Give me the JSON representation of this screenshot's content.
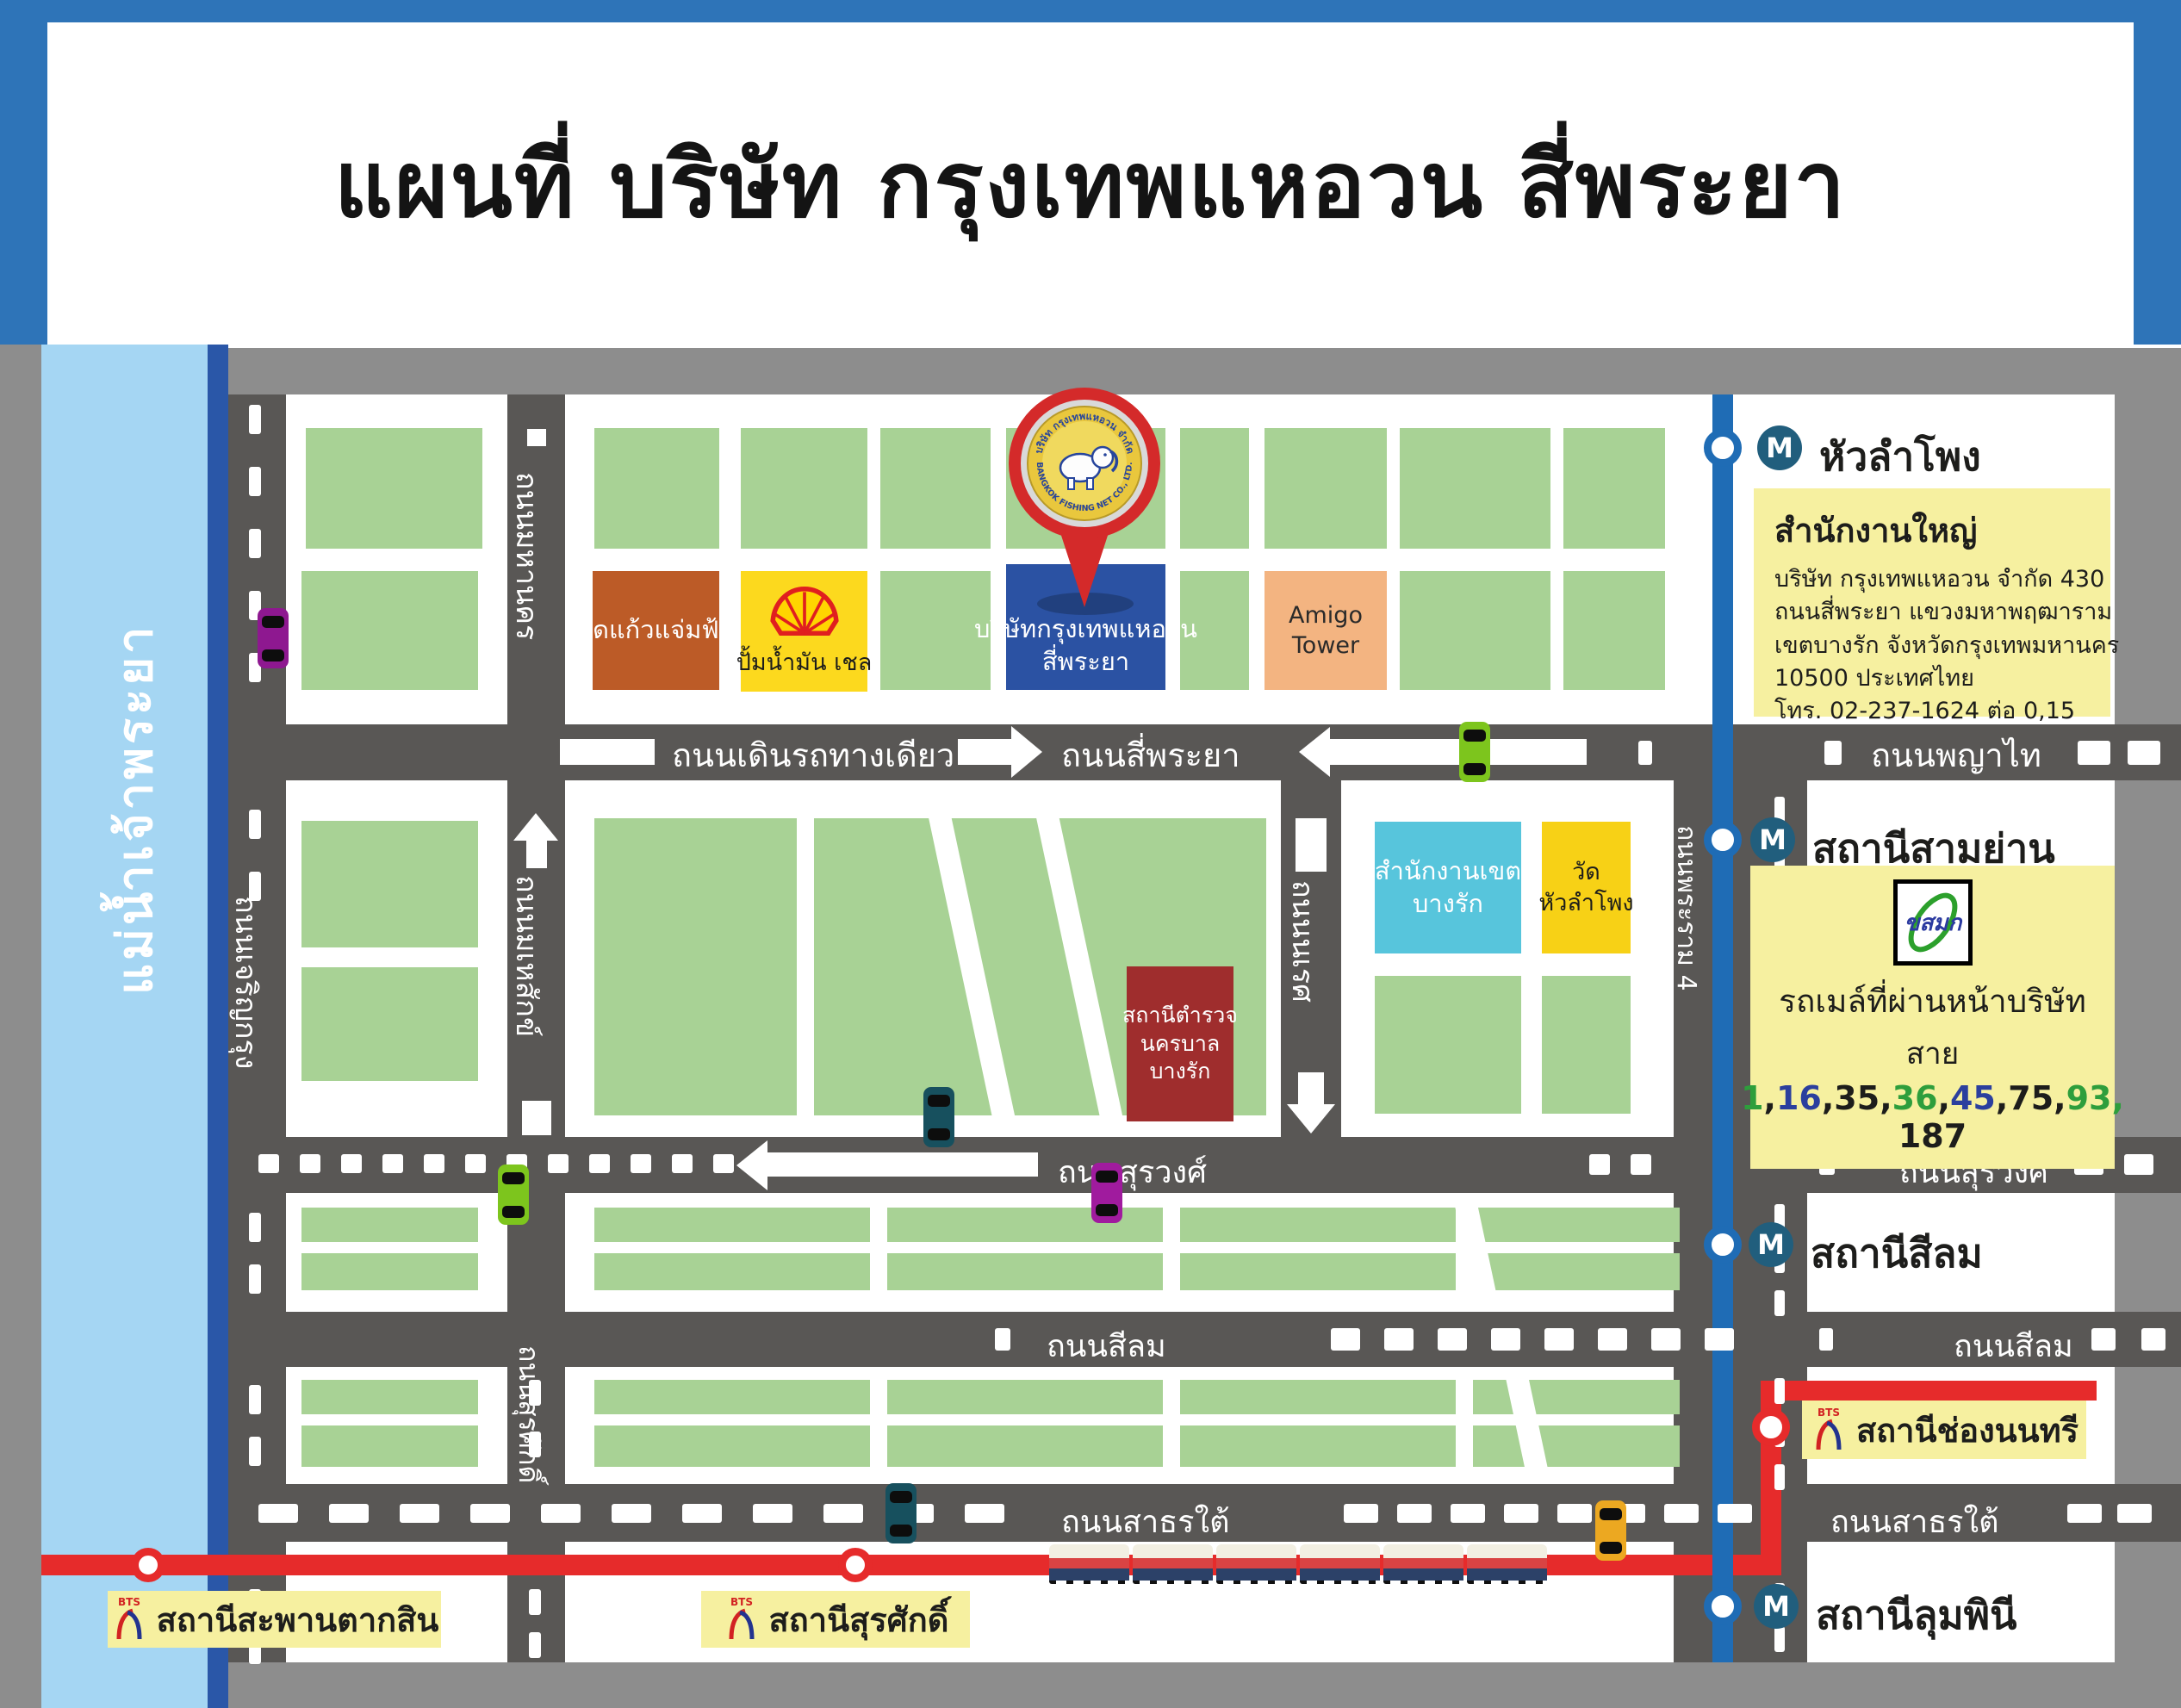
{
  "title": "แผนที่ บริษัท กรุงเทพแหอวน สี่พระยา",
  "river": {
    "name": "แม่น้ำเจ้าพระยา"
  },
  "roads": {
    "one_way": "ถนนเดินรถทางเดียว",
    "si_phraya": "ถนนสี่พระยา",
    "phaya_thai": "ถนนพญาไท",
    "surawong": "ถนนสุรวงศ์",
    "silom": "ถนนสีลม",
    "sathorn_tai": "ถนนสาธรใต้",
    "charoen_krung": "ถนนเจริญกรุง",
    "maha_nakhon": "ถนนมหานคร",
    "mahesak": "ถนนมเหสักข์",
    "naret": "ถนนนเรศ",
    "surasak": "ถนนสุรศักดิ์",
    "rama4": "ถนนพระราม 4"
  },
  "buildings": {
    "wat_kaew": "วัดแก้วแจ่มฟ้า",
    "shell": "ปั้มน้ำมัน เชล",
    "company_line1": "บริษัทกรุงเทพแหอวน",
    "company_line2": "สี่พระยา",
    "amigo_line1": "Amigo",
    "amigo_line2": "Tower",
    "district_line1": "สำนักงานเขต",
    "district_line2": "บางรัก",
    "wat_hl_line1": "วัด",
    "wat_hl_line2": "หัวลำโพง",
    "police_line1": "สถานีตำรวจ",
    "police_line2": "นครบาล",
    "police_line3": "บางรัก"
  },
  "pin": {
    "arc_top": "บริษัท กรุงเทพแหอวน จำกัด",
    "arc_bottom": "BANGKOK FISHING NET CO., LTD."
  },
  "mrt": {
    "icon": "M",
    "stations": {
      "hua_lamphong": "หัวลำโพง",
      "sam_yan": "สถานีสามย่าน",
      "silom": "สถานีสีลม",
      "lumpini": "สถานีลุมพินี"
    }
  },
  "bts": {
    "logo": "BTS",
    "stations": {
      "chong_nonsi": "สถานีช่องนนทรี",
      "taksin": "สถานีสะพานตากสิน",
      "surasak": "สถานีสุรศักดิ์"
    }
  },
  "office_box": {
    "title": "สำนักงานใหญ่",
    "line1": "บริษัท กรุงเทพแหอวน จำกัด 430",
    "line2": "ถนนสี่พระยา แขวงมหาพฤฒาราม",
    "line3": "เขตบางรัก จังหวัดกรุงเทพมหานคร",
    "line4": "10500 ประเทศไทย",
    "line5": "โทร. 02-237-1624 ต่อ 0,15"
  },
  "bus_box": {
    "logo_text": "ขสมก",
    "heading": "รถเมล์ที่ผ่านหน้าบริษัท",
    "sub": "สาย",
    "lines": [
      {
        "n": "1",
        "c": "#2e9e3c"
      },
      {
        "n": "16",
        "c": "#2b3f9e"
      },
      {
        "n": "35",
        "c": "#1d1d1b"
      },
      {
        "n": "36",
        "c": "#2e9e3c"
      },
      {
        "n": "45",
        "c": "#2b3f9e"
      },
      {
        "n": "75",
        "c": "#1d1d1b"
      },
      {
        "n": "93",
        "c": "#2e9e3c"
      }
    ],
    "last_line": "187"
  },
  "colors": {
    "header_blue": "#2e74b8",
    "road_gray": "#595755",
    "map_border": "#8d8d8d",
    "block_green": "#a8d295",
    "river_blue": "#a5d6f3",
    "mrt_line": "#1f6cb5",
    "bts_line": "#e62b2b",
    "info_yellow": "#f6f0a0",
    "pin_red": "#d42a2a"
  }
}
